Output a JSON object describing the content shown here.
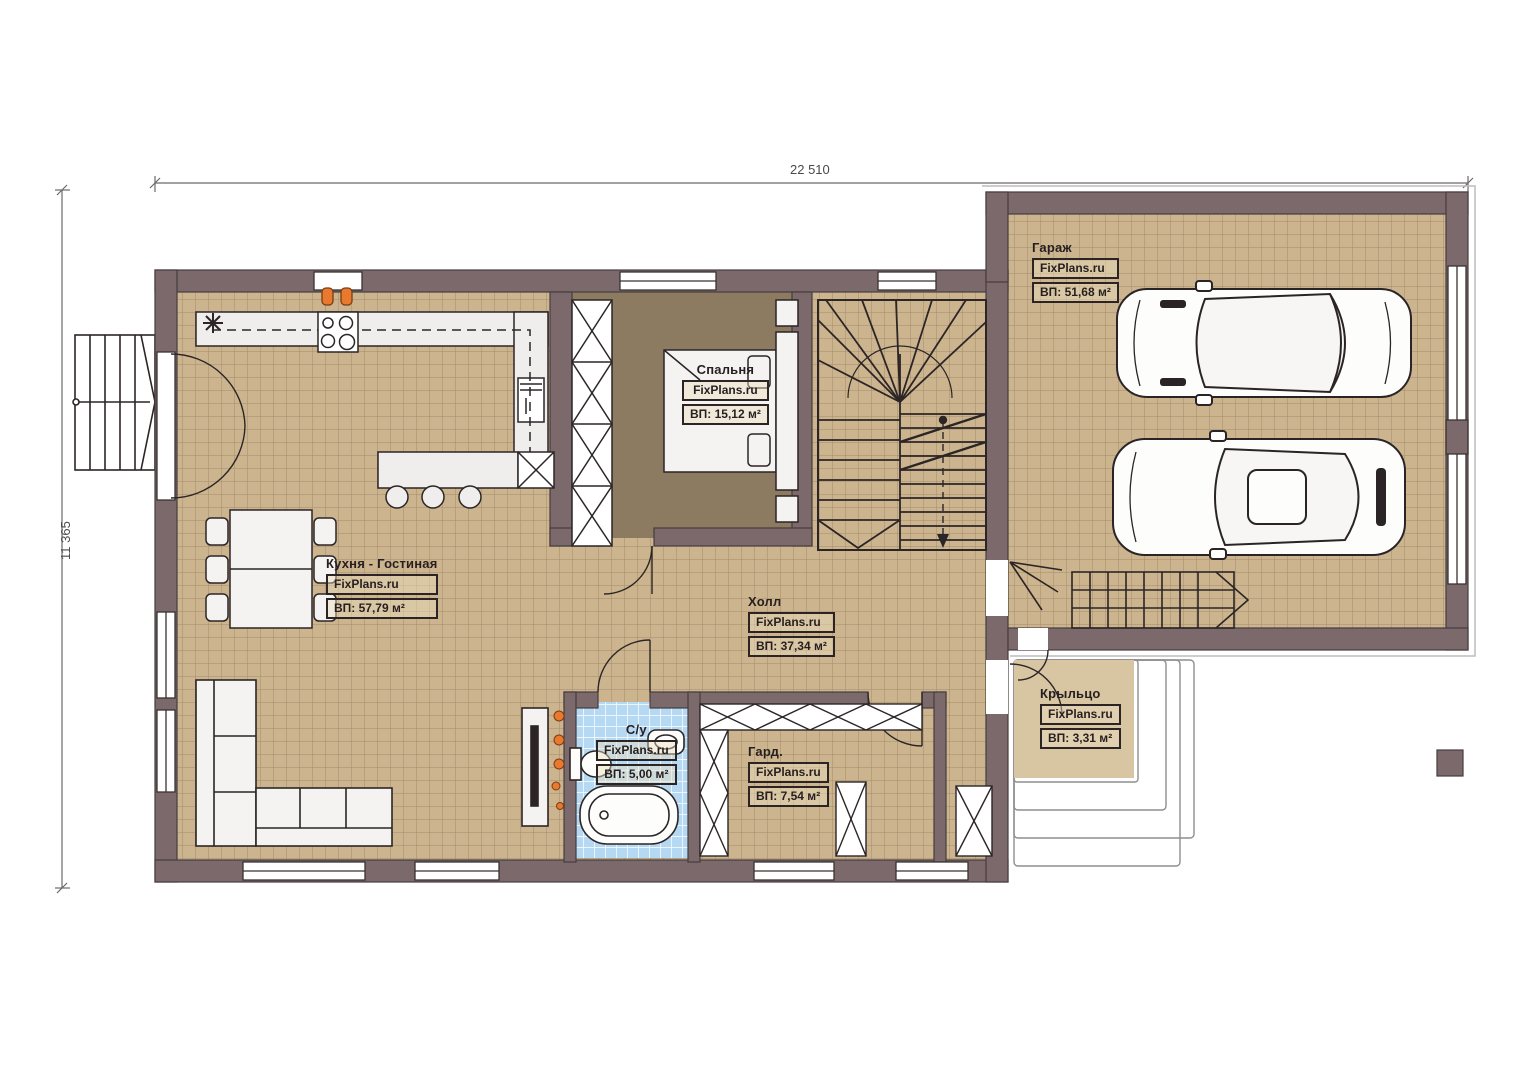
{
  "plan": {
    "watermark": "FixPlans.ru",
    "dimensions": {
      "width_top": "22 510",
      "height_left": "11 365"
    },
    "rooms": [
      {
        "key": "garage",
        "name": "Гараж",
        "area": "ВП: 51,68 м²"
      },
      {
        "key": "bedroom",
        "name": "Спальня",
        "area": "ВП: 15,12 м²"
      },
      {
        "key": "kitchen-living",
        "name": "Кухня - Гостиная",
        "area": "ВП: 57,79 м²"
      },
      {
        "key": "hall",
        "name": "Холл",
        "area": "ВП: 37,34 м²"
      },
      {
        "key": "bathroom",
        "name": "С/у",
        "area": "ВП: 5,00 м²"
      },
      {
        "key": "wardrobe",
        "name": "Гард.",
        "area": "ВП: 7,54 м²"
      },
      {
        "key": "porch",
        "name": "Крыльцо",
        "area": "ВП: 3,31 м²"
      }
    ],
    "colors": {
      "wall": "#7c696c",
      "floor_tile": "#ccb58e",
      "floor_grid": "#a38c69",
      "bedroom_carpet": "#8c7b60",
      "bath_tile": "#b5d8f3",
      "porch_floor": "#d8c5a2",
      "accent_orange": "#e8792e"
    }
  }
}
